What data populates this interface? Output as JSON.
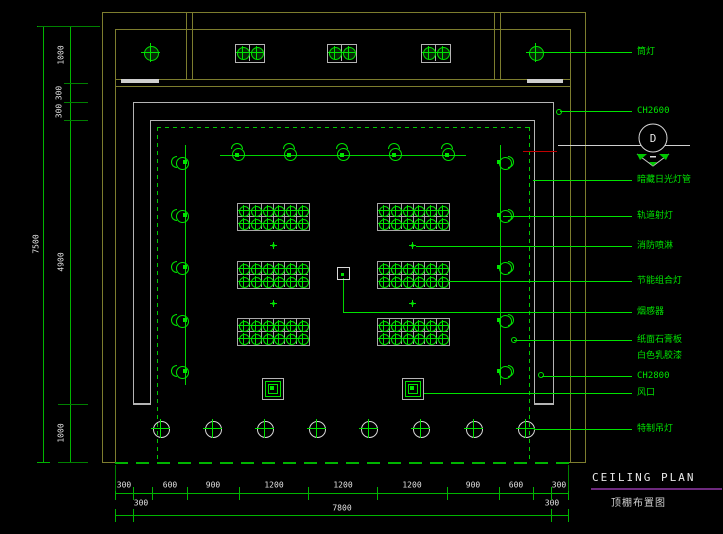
{
  "drawing": {
    "title_en": "CEILING PLAN",
    "title_cn": "顶棚布置图",
    "detail_marker": "D"
  },
  "legend": {
    "items": [
      {
        "text": "筒灯"
      },
      {
        "text": "CH2600"
      },
      {
        "text": "暗藏日光灯管"
      },
      {
        "text": "轨道射灯"
      },
      {
        "text": "消防喷淋"
      },
      {
        "text": "节能组合灯"
      },
      {
        "text": "烟感器"
      },
      {
        "text": "纸面石膏板"
      },
      {
        "text": "白色乳胶漆"
      },
      {
        "text": "CH2800"
      },
      {
        "text": "风口"
      },
      {
        "text": "特制吊灯"
      }
    ]
  },
  "dimensions": {
    "bottom_row1": [
      "300",
      "600",
      "900",
      "1200",
      "1200",
      "1200",
      "900",
      "600",
      "300"
    ],
    "bottom_row2": {
      "left": "300",
      "total": "7800",
      "right": "300"
    },
    "left_chain": [
      "1000",
      "300",
      "300",
      "4900",
      "1000"
    ],
    "left_total": "7500"
  },
  "colors": {
    "background": "#000000",
    "symbol_green": "#00e400",
    "wall_olive": "#7d7d2e",
    "wall_gray": "#b4b4b4",
    "dimension_text": "#e2e2e2",
    "title_underline": "#6e2a7e",
    "section_cut_red": "#c00000"
  }
}
